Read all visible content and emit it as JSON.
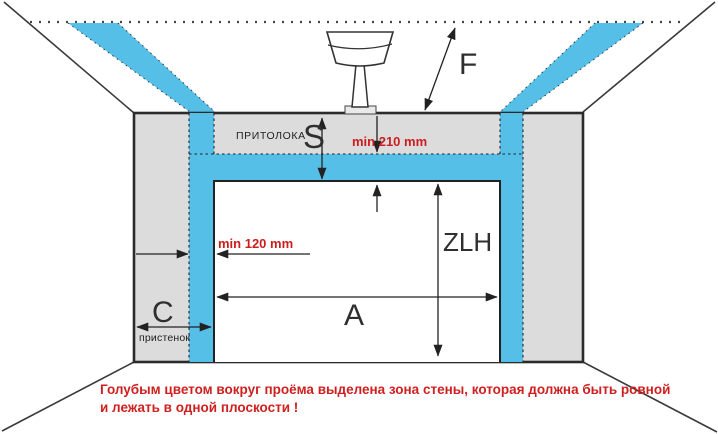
{
  "diagram": {
    "title_implicit": "garage-door-opening-dimensions",
    "labels": {
      "lintel_caption": "ПРИТОЛОКА",
      "lintel_dim": "S",
      "headroom_dim": "F",
      "opening_height_dim": "ZLH",
      "opening_width_dim": "A",
      "pier_dim": "C",
      "pier_caption": "пристенок",
      "min_top_zone": "min 210 mm",
      "min_side_zone": "min 120 mm"
    },
    "note": {
      "line1": "Голубым цветом вокруг проёма выделена зона стены, которая должна быть ровной",
      "line2": "и лежать в одной плоскости !"
    },
    "icons": {
      "ceiling_lamp": "lamp hanging between ceiling line and wall top",
      "ceiling_dotted_line": "garage ceiling level",
      "blue_zone": "flat wall zone around opening"
    },
    "colors": {
      "zone_blue": "#56bfe7",
      "wall_gray": "#dcdcdc",
      "line_dark": "#2b2b2b",
      "dim_red": "#cc1e1e",
      "lamp_base_gray": "#e9e9e9"
    }
  }
}
